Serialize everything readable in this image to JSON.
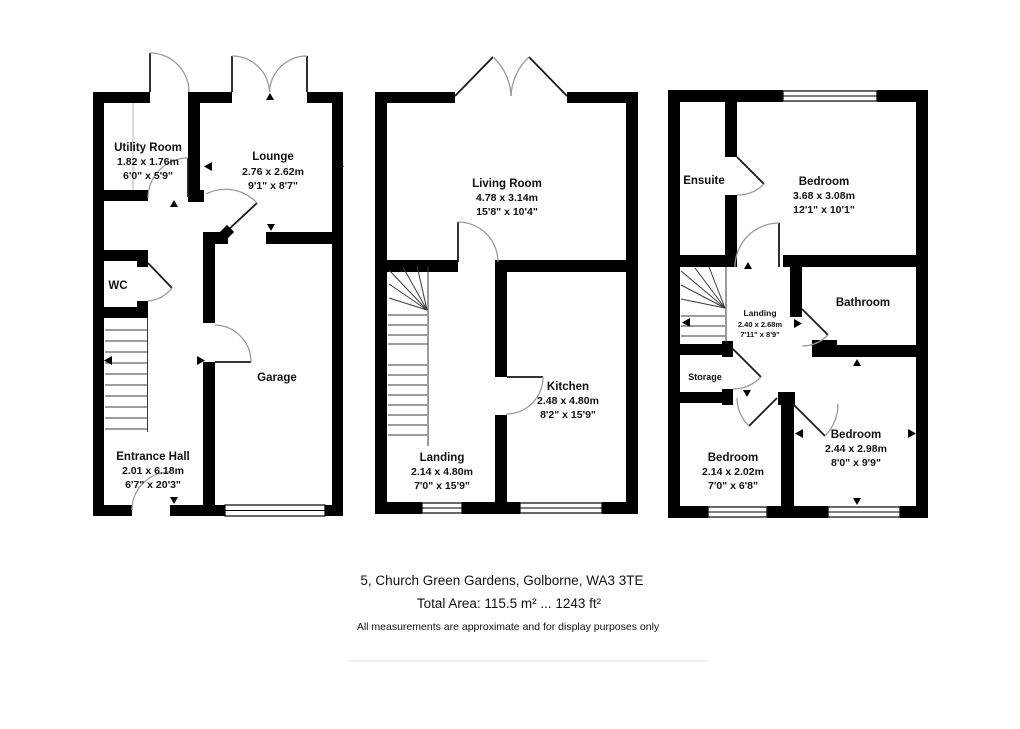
{
  "colors": {
    "wall": "#000000",
    "background": "#ffffff",
    "door_arc": "#9a9a9a"
  },
  "floors": {
    "ground": {
      "rooms": [
        {
          "name": "Utility Room",
          "metric": "1.82 x 1.76m",
          "imperial": "6'0\" x 5'9\""
        },
        {
          "name": "Lounge",
          "metric": "2.76 x 2.62m",
          "imperial": "9'1\" x 8'7\""
        },
        {
          "name": "WC"
        },
        {
          "name": "Garage"
        },
        {
          "name": "Entrance Hall",
          "metric": "2.01 x 6.18m",
          "imperial": "6'7\" x 20'3\""
        }
      ]
    },
    "first": {
      "rooms": [
        {
          "name": "Living Room",
          "metric": "4.78 x 3.14m",
          "imperial": "15'8\" x 10'4\""
        },
        {
          "name": "Kitchen",
          "metric": "2.48 x 4.80m",
          "imperial": "8'2\" x 15'9\""
        },
        {
          "name": "Landing",
          "metric": "2.14 x 4.80m",
          "imperial": "7'0\" x 15'9\""
        }
      ]
    },
    "second": {
      "rooms": [
        {
          "name": "Ensuite"
        },
        {
          "name": "Bedroom",
          "metric": "3.68 x 3.08m",
          "imperial": "12'1\" x 10'1\""
        },
        {
          "name": "Bathroom"
        },
        {
          "name": "Landing",
          "metric": "2.40 x 2.68m",
          "imperial": "7'11\" x 8'9\""
        },
        {
          "name": "Storage"
        },
        {
          "name": "Bedroom",
          "metric": "2.14 x 2.02m",
          "imperial": "7'0\" x 6'8\""
        },
        {
          "name": "Bedroom",
          "metric": "2.44 x 2.98m",
          "imperial": "8'0\" x 9'9\""
        }
      ]
    }
  },
  "footer": {
    "address": "5, Church Green Gardens, Golborne, WA3 3TE",
    "total_area": "Total Area: 115.5 m² ... 1243 ft²",
    "disclaimer": "All measurements are approximate and for display purposes only"
  }
}
